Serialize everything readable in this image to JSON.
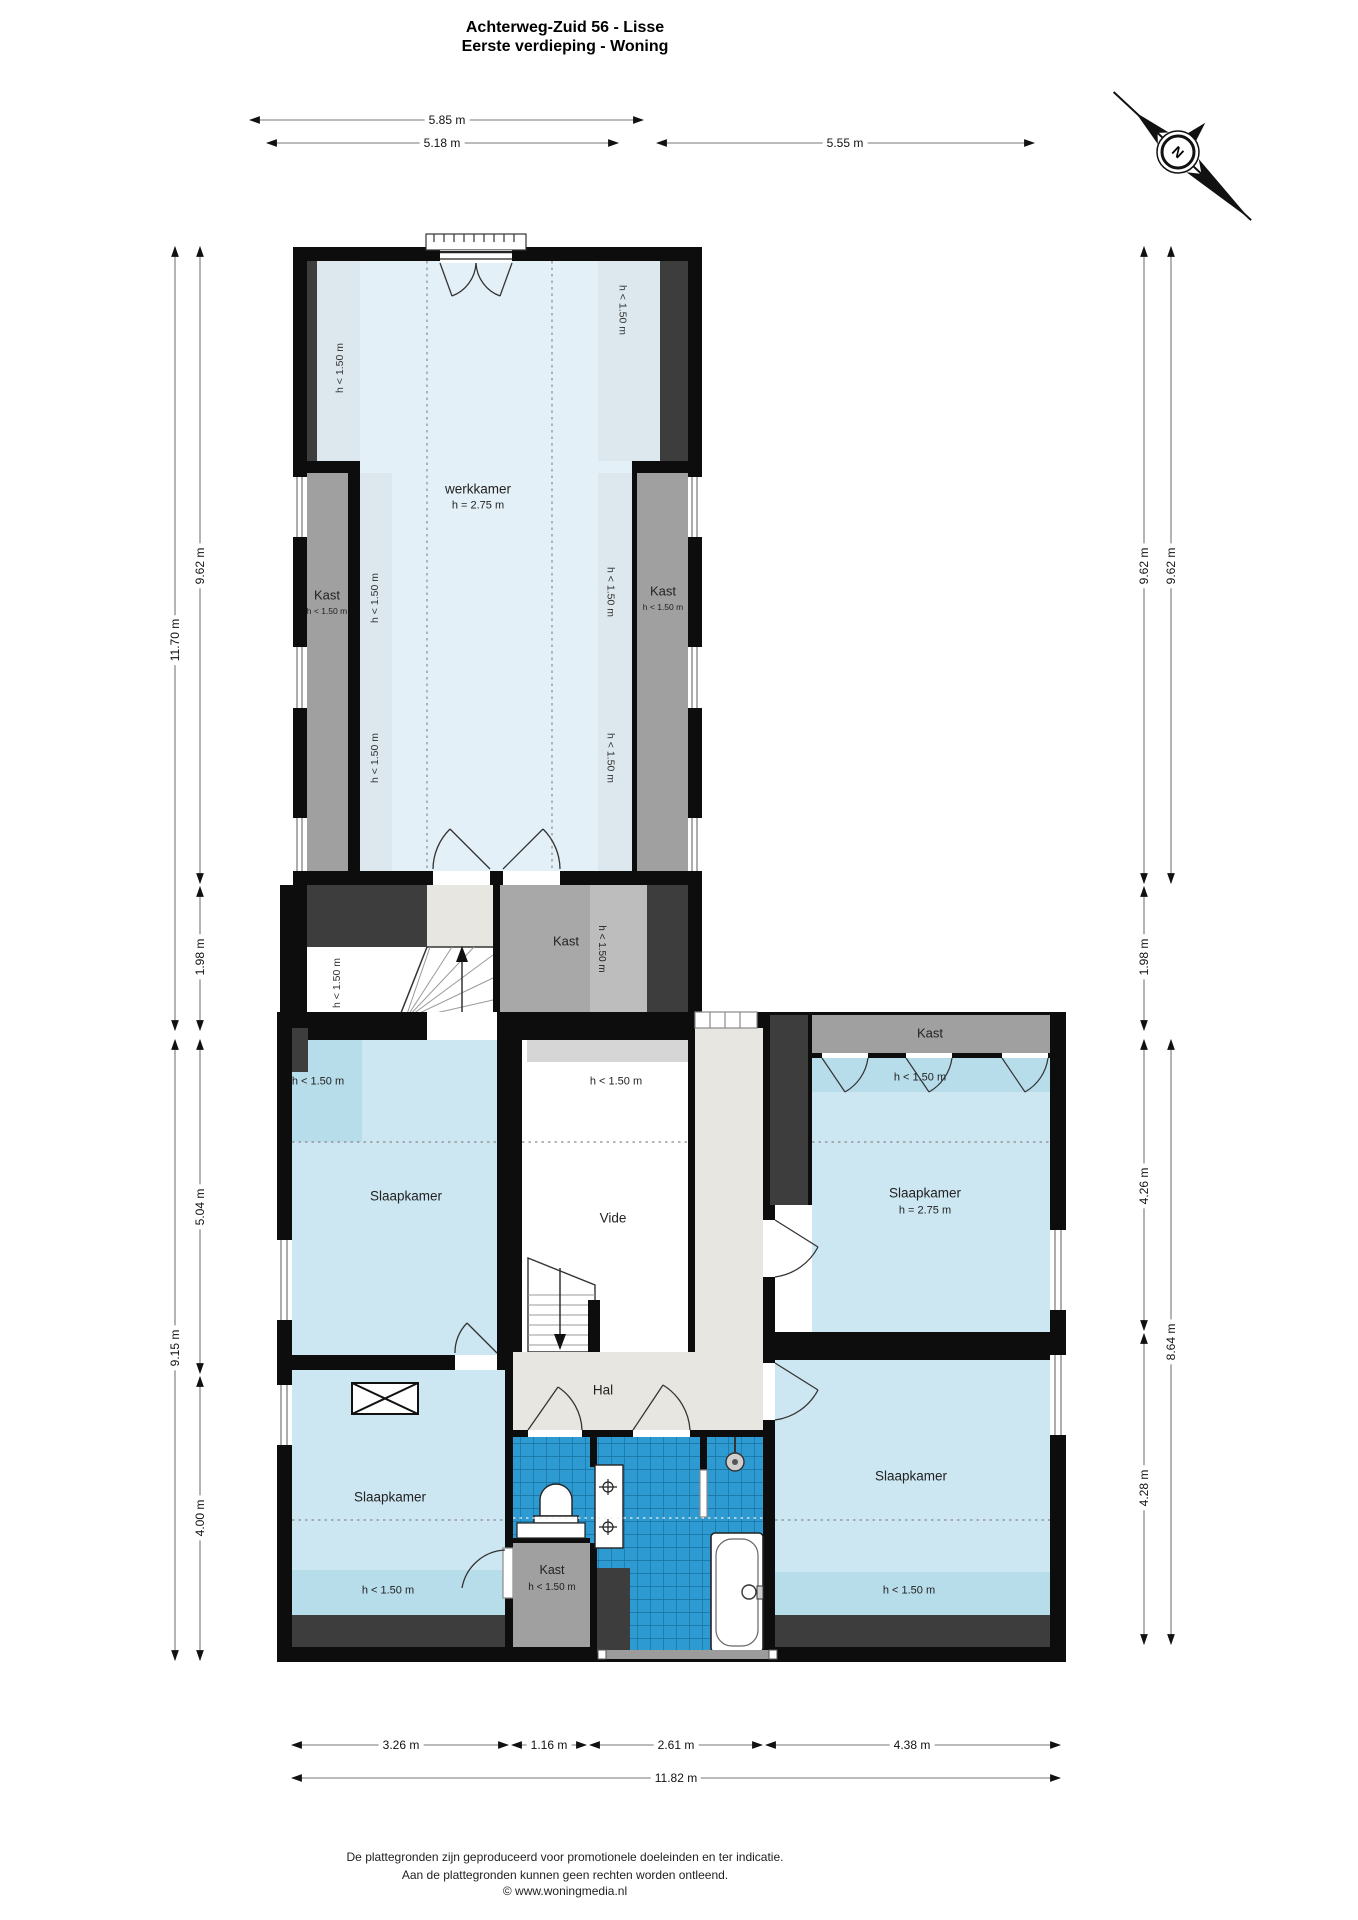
{
  "title": {
    "line1": "Achterweg-Zuid 56 - Lisse",
    "line2": "Eerste verdieping - Woning"
  },
  "compass": {
    "north": "N"
  },
  "dimensions": {
    "top": [
      "5.85 m",
      "5.18 m",
      "5.55 m"
    ],
    "left": [
      "11.70 m",
      "9.62 m",
      "1.98 m",
      "9.15 m",
      "5.04 m",
      "4.00 m"
    ],
    "right": [
      "9.62 m",
      "9.62 m",
      "1.98 m",
      "4.26 m",
      "8.64 m",
      "4.28 m"
    ],
    "bottom": [
      "3.26 m",
      "1.16 m",
      "2.61 m",
      "4.38 m",
      "11.82 m"
    ]
  },
  "rooms": {
    "werkkamer": "werkkamer",
    "werkkamer_height": "h = 2.75 m",
    "kast": "Kast",
    "height_lt_150": "h < 1.50 m",
    "slaapkamer": "Slaapkamer",
    "slaapkamer_height": "h = 2.75 m",
    "vide": "Vide",
    "hal": "Hal"
  },
  "footer": {
    "line1": "De plattegronden zijn geproduceerd voor promotionele doeleinden en ter indicatie.",
    "line2": "Aan de plattegronden kunnen geen rechten worden ontleend.",
    "line3": "© www.woningmedia.nl"
  },
  "colors": {
    "room_blue": "#cde7f2",
    "room_blue_dark": "#b7dcea",
    "werkkamer_blue": "#e4f0f7",
    "strip_blue": "#dce8ee",
    "tile_blue": "#2e9ad2",
    "kast_gray": "#a0a0a0",
    "wall_black": "#0d0d0d",
    "wall_dark": "#3d3d3d",
    "hal_beige": "#e8e6e1"
  }
}
